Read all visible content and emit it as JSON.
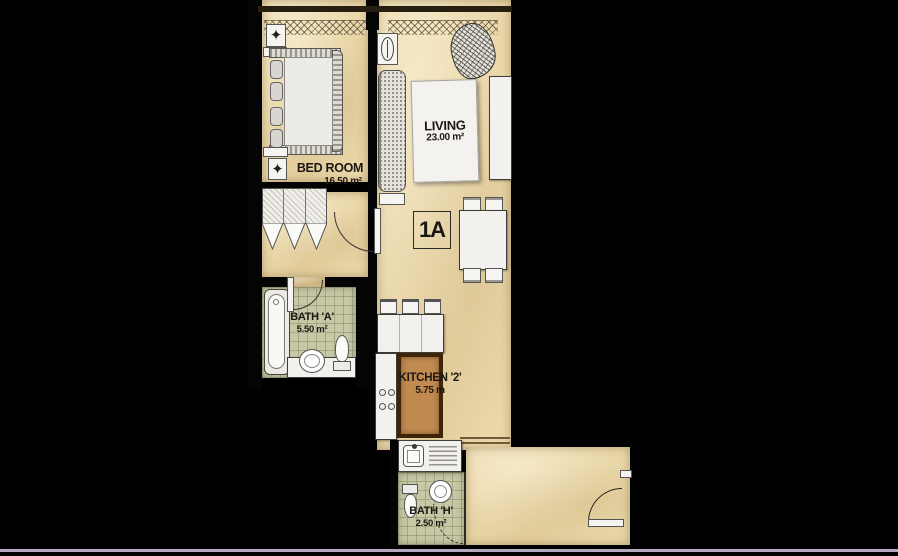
{
  "unit": {
    "label": "1A"
  },
  "rooms": {
    "bedroom": {
      "name": "BED ROOM",
      "area": "16.50 m²"
    },
    "living": {
      "name": "LIVING",
      "area": "23.00 m²"
    },
    "bath_a": {
      "name": "BATH 'A'",
      "area": "5.50 m²"
    },
    "kitchen": {
      "name": "KITCHEN '2'",
      "area": "5.75 m"
    },
    "bath_h": {
      "name": "BATH 'H'",
      "area": "2.50 m²"
    }
  },
  "fixtures": {
    "bedroom": [
      "bed-icon",
      "wardrobe-icon",
      "ac-louvre-icon",
      "nightstand-icon"
    ],
    "living": [
      "sofa-icon",
      "rug-icon",
      "plant-icon",
      "tv-console-icon",
      "ceiling-fan-icon",
      "dining-table-icon",
      "dining-chair-icon"
    ],
    "kitchen": [
      "counter-icon",
      "stove-icon",
      "bar-stool-icon",
      "sink-counter-icon"
    ],
    "bath_a": [
      "bathtub-icon",
      "washbasin-icon",
      "toilet-icon",
      "door-swing-icon"
    ],
    "bath_h": [
      "toilet-icon",
      "round-basin-icon",
      "door-swing-dashed-icon"
    ],
    "entry": [
      "entry-door-swing-icon"
    ]
  },
  "symbols": {
    "ac_louvre_glyph": "✦"
  },
  "colors": {
    "background": "#000000",
    "floor": "#ead8ab",
    "bath_tile": "#c6c8a6",
    "kitchen_mat": "#c08a50",
    "kitchen_mat_border": "#3f2408",
    "fixture": "#f2f1ed",
    "accent_line": "#b2a9be",
    "wall": "#040404"
  }
}
